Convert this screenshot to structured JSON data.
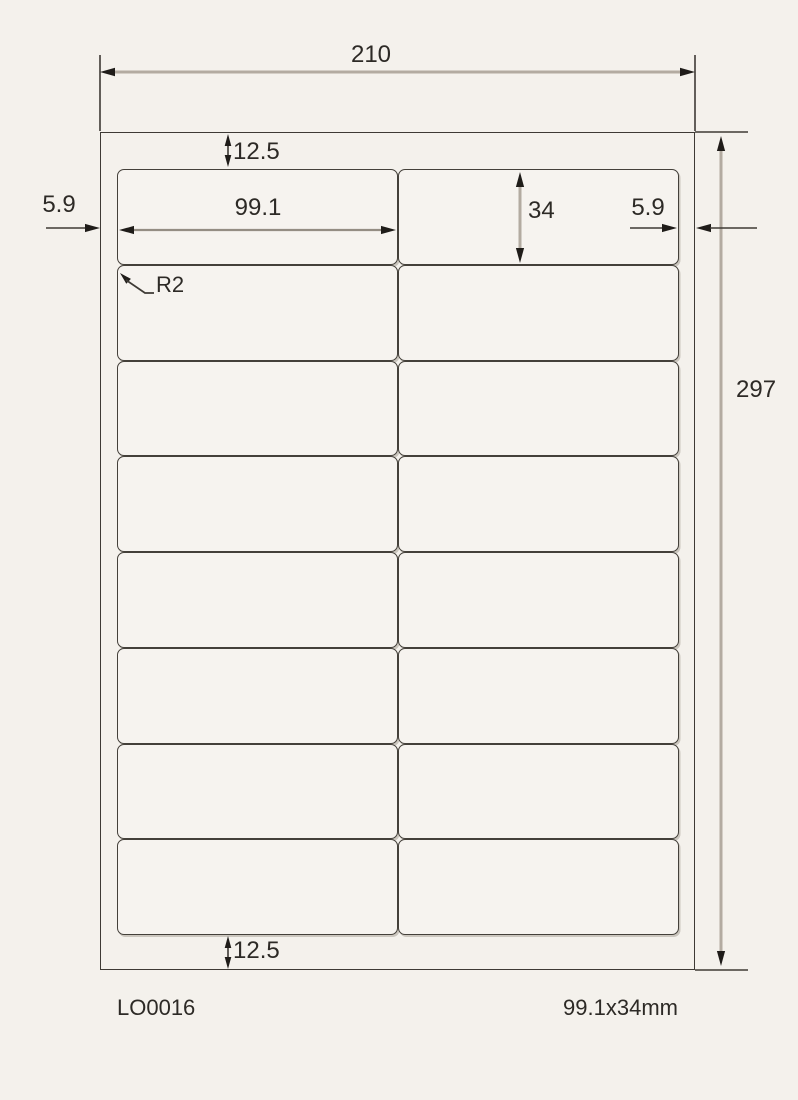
{
  "diagram": {
    "sheet": {
      "width": "210",
      "height": "297"
    },
    "margins": {
      "top": "12.5",
      "bottom": "12.5",
      "left": "5.9",
      "right": "5.9"
    },
    "label": {
      "width": "99.1",
      "height": "34",
      "corner_radius": "R2"
    },
    "grid": {
      "rows": 8,
      "columns": 2,
      "label_count": 16
    },
    "footer": {
      "product_code": "LO0016",
      "label_size": "99.1x34mm"
    },
    "colors": {
      "background": "#f4f1ec",
      "outline": "#3e3a35",
      "dimension_shaft": "#b3aba1",
      "text": "#2d2a26"
    }
  }
}
